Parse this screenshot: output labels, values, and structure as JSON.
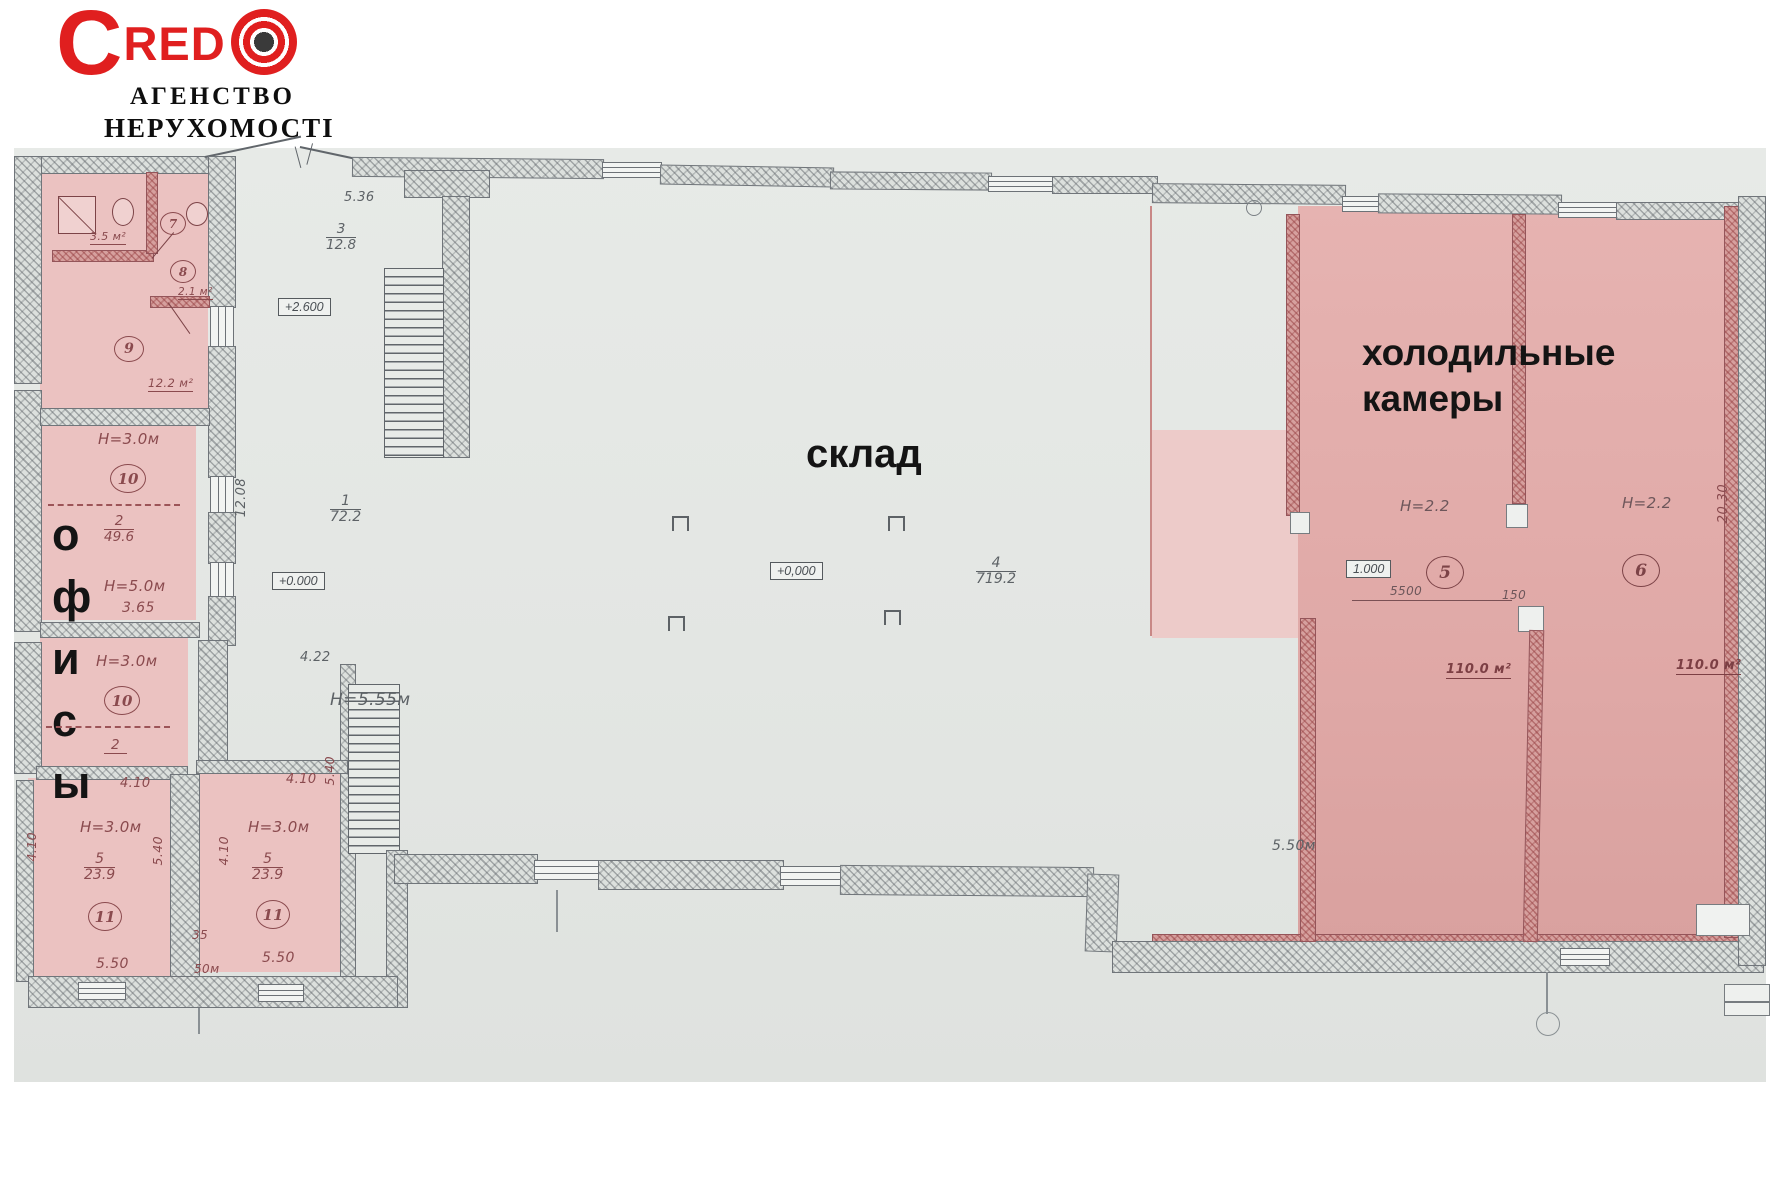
{
  "logo": {
    "c": "C",
    "red": "RED",
    "line1": "АГЕНСТВО",
    "line2": "НЕРУХОМОСТІ"
  },
  "zones": {
    "offices": "офисы",
    "warehouse": "склад",
    "cold1": "холодильные",
    "cold2": "камеры"
  },
  "bath": {
    "area1": "3.5 м²",
    "room7": "7",
    "room8": "8",
    "area2": "2.1 м²",
    "room9": "9",
    "area9": "12.2 м²"
  },
  "o10a": {
    "h": "Н=3.0м",
    "num": "10",
    "fn": "2",
    "fd": "49.6"
  },
  "mid": {
    "h": "Н=5.0м",
    "d": "3.65"
  },
  "o10b": {
    "h": "Н=3.0м",
    "num": "10",
    "fn": "2"
  },
  "r11a": {
    "top": "4.10",
    "h": "Н=3.0м",
    "fn": "5",
    "fd": "23.9",
    "num": "11",
    "bottom": "5.50",
    "left": "4.10",
    "right": "5.40"
  },
  "r11b": {
    "top": "4.10",
    "h": "Н=3.0м",
    "fn": "5",
    "fd": "23.9",
    "num": "11",
    "bottom": "5.50",
    "left": "4.10",
    "right": "5.40"
  },
  "pillar": {
    "w": "35",
    "d": "50м"
  },
  "wh": {
    "porch": "5.36",
    "r3n": "3",
    "r3a": "12.8",
    "lvl26": "+2.600",
    "r1n": "1",
    "r1a": "72.2",
    "d1208": "12.08",
    "lvl0": "+0.000",
    "h": "Н=5.55м",
    "d422": "4.22",
    "lvl0b": "+0,000",
    "r4n": "4",
    "r4a": "719.2"
  },
  "cold": {
    "h5": "Н=2.2",
    "h6": "Н=2.2",
    "r5": "5",
    "r6": "6",
    "lvl": "1.000",
    "d5500": "5500",
    "d150": "150",
    "a5": "110.0 м²",
    "a6": "110.0 м²",
    "d550": "5.50м",
    "d2030": "20.30"
  }
}
